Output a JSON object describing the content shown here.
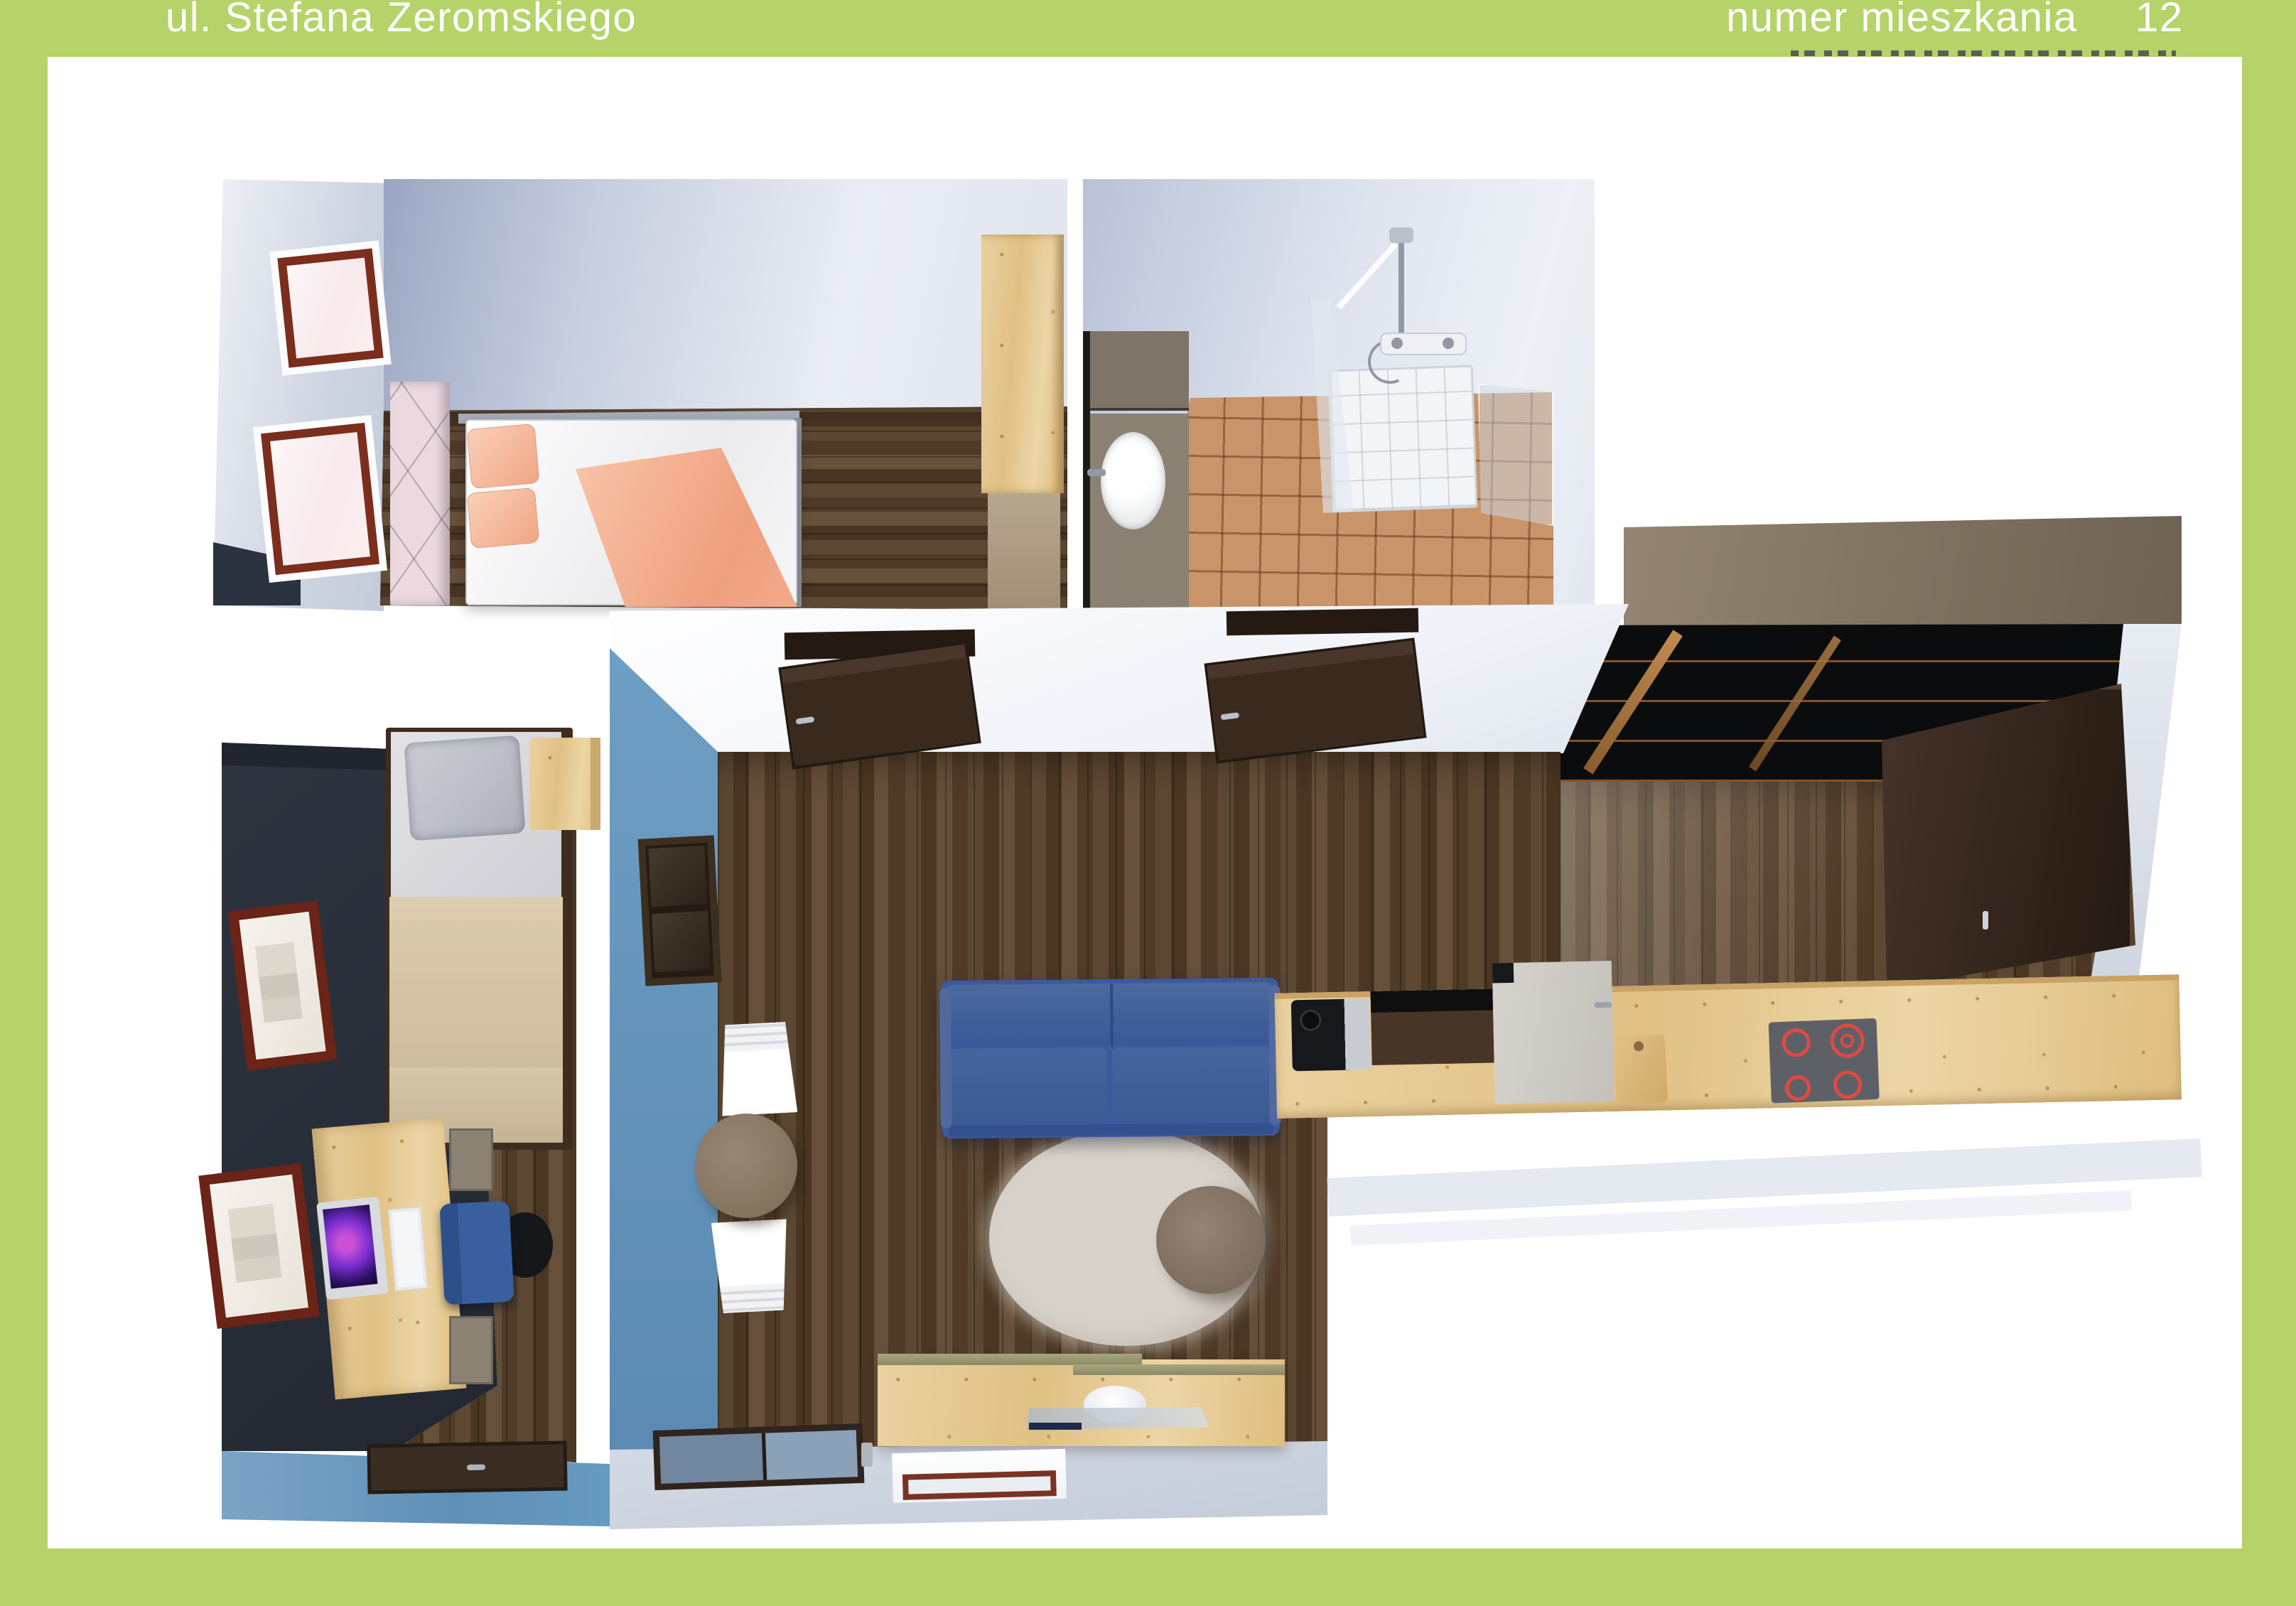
{
  "header": {
    "street": "ul. Stefana Żeromskiego",
    "apartment_label": "numer mieszkania",
    "apartment_number": "12"
  },
  "palette": {
    "green": "#b5d369",
    "panel": "#ffffff",
    "wall_light": "#dfe4ee",
    "wall_shadow": "#9aa6c2",
    "floor_dark": "#53402c",
    "pine": "#e6c88f",
    "tile": "#c99469",
    "taupe_band": "#8a7c6b",
    "sofa": "#3c59a0",
    "accent_blue": "#5988b0",
    "office_wall": "#2e3540",
    "peach": "#f0a583",
    "window_frame": "#7c2e1d",
    "cooktop_ring": "#e34842",
    "rug": "#d9d2c9",
    "door_brown": "#3a2a1d"
  },
  "floor_plan": {
    "view": "3d-top-down-render",
    "rooms": [
      {
        "name": "bedroom",
        "furniture": [
          "double-bed",
          "wardrobe",
          "two-windows",
          "headboard-wall"
        ]
      },
      {
        "name": "bathroom",
        "furniture": [
          "washbasin-cabinet",
          "shower-enclosure",
          "shower-tray",
          "tiled-floor"
        ]
      },
      {
        "name": "kitchen",
        "furniture": [
          "counter-run",
          "induction-cooktop",
          "wall-cabinet",
          "coffee-machine",
          "cutting-board"
        ]
      },
      {
        "name": "living-room",
        "furniture": [
          "blue-sofa",
          "oval-rug",
          "coffee-table",
          "dining-table",
          "two-white-chairs",
          "tv-sideboard",
          "open-doors"
        ]
      },
      {
        "name": "office-bedroom",
        "furniture": [
          "single-bed",
          "desk",
          "monitor",
          "office-chair",
          "nightstand",
          "two-wall-frames",
          "doormat"
        ]
      }
    ]
  }
}
